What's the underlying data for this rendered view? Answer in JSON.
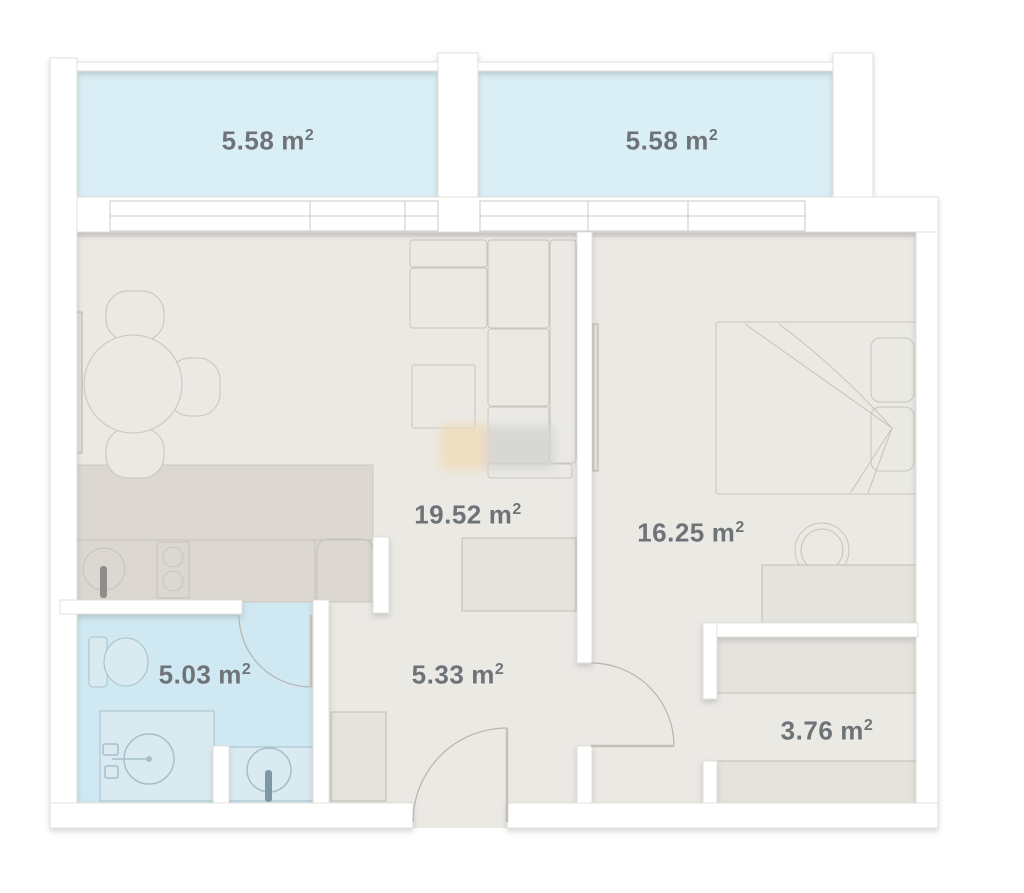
{
  "plan_type": "apartment-floor-plan",
  "rooms": {
    "balcony_left": {
      "name": "balcony-left",
      "area": "5.58",
      "unit": "m",
      "exp": "2"
    },
    "balcony_right": {
      "name": "balcony-right",
      "area": "5.58",
      "unit": "m",
      "exp": "2"
    },
    "living_room": {
      "name": "living-room",
      "area": "19.52",
      "unit": "m",
      "exp": "2"
    },
    "bedroom": {
      "name": "bedroom",
      "area": "16.25",
      "unit": "m",
      "exp": "2"
    },
    "bathroom": {
      "name": "bathroom",
      "area": "5.03",
      "unit": "m",
      "exp": "2"
    },
    "hallway": {
      "name": "hallway",
      "area": "5.33",
      "unit": "m",
      "exp": "2"
    },
    "wardrobe": {
      "name": "wardrobe",
      "area": "3.76",
      "unit": "m",
      "exp": "2"
    }
  },
  "colors": {
    "balcony_floor": "#daeef5",
    "bathroom_floor": "#cfe8f2",
    "floor": "#ebe9e4",
    "kitchen_counter": "#dcd7d1",
    "wall": "#ffffff",
    "label_text": "#6e7378",
    "watermark_tan": "#f0dcb8",
    "watermark_gray": "#d5d5d3"
  }
}
